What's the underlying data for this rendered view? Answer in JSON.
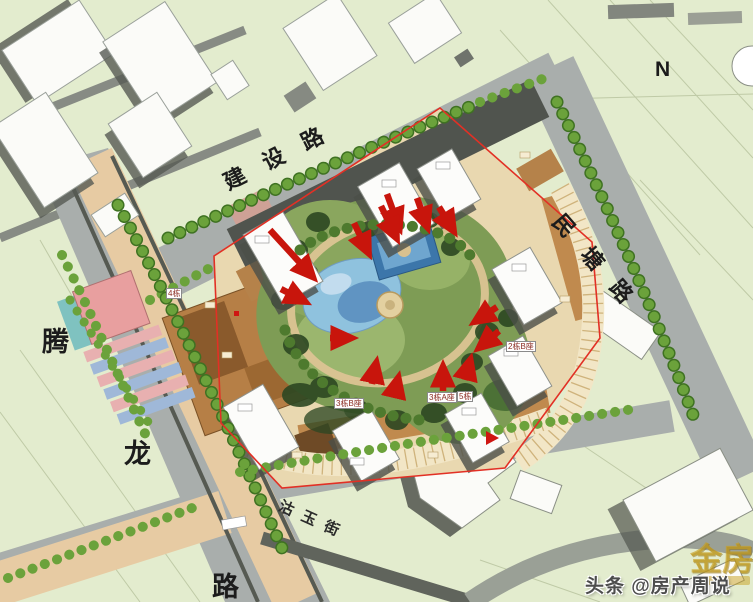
{
  "roads": {
    "jianshe": "建 设 路",
    "mintang": "民 塘 路",
    "tenglong": [
      "腾",
      "龙",
      "路"
    ],
    "guyu": "沽 玉 街"
  },
  "compass": "N",
  "buildings": [
    {
      "label": "3栋B座"
    },
    {
      "label": "3栋A座"
    },
    {
      "label": "5栋"
    },
    {
      "label": "2栋B座"
    },
    {
      "label": "4栋"
    }
  ],
  "watermark": {
    "main": "头条 @房产周说",
    "logo": "金房"
  },
  "legend_colors": {
    "arrow_red": "#c8150c",
    "boundary_red": "#e23025",
    "road_gray": "#a9aeac",
    "avenue_tan": "#e7cba3",
    "background_green": "#e3ecce",
    "commercial_brown": "#b67f46",
    "garden_green": "#7e9c55",
    "pond_blue": "#8fc2de"
  }
}
